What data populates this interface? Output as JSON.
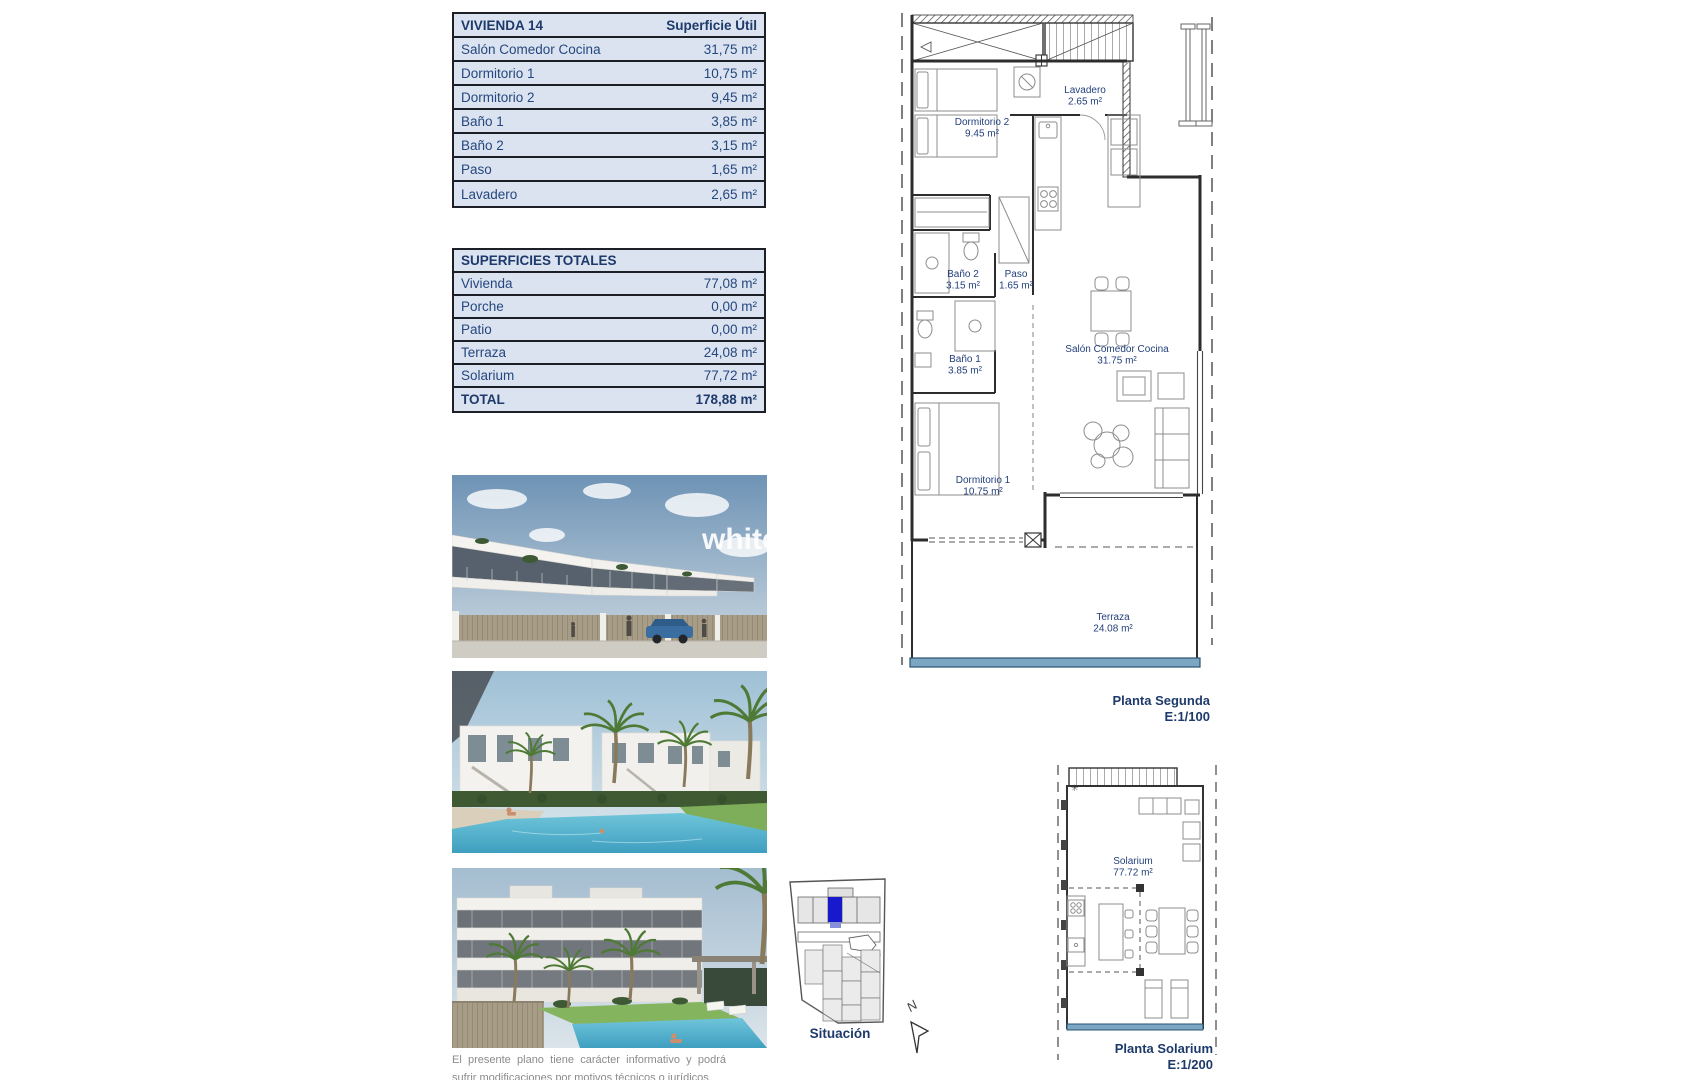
{
  "unit_table": {
    "title": "VIVIENDA 14",
    "column_header": "Superficie Útil",
    "rows": [
      {
        "label": "Salón Comedor Cocina",
        "value": "31,75 m²"
      },
      {
        "label": "Dormitorio 1",
        "value": "10,75 m²"
      },
      {
        "label": "Dormitorio 2",
        "value": "9,45 m²"
      },
      {
        "label": "Baño 1",
        "value": "3,85 m²"
      },
      {
        "label": "Baño 2",
        "value": "3,15 m²"
      },
      {
        "label": "Paso",
        "value": "1,65 m²"
      },
      {
        "label": "Lavadero",
        "value": "2,65 m²"
      }
    ]
  },
  "totals_table": {
    "title": "SUPERFICIES TOTALES",
    "rows": [
      {
        "label": "Vivienda",
        "value": "77,08 m²"
      },
      {
        "label": "Porche",
        "value": "0,00 m²"
      },
      {
        "label": "Patio",
        "value": "0,00 m²"
      },
      {
        "label": "Terraza",
        "value": "24,08 m²"
      },
      {
        "label": "Solarium",
        "value": "77,72 m²"
      }
    ],
    "total_row": {
      "label": "TOTAL",
      "value": "178,88 m²"
    }
  },
  "floor_plan_segunda": {
    "caption": "Planta Segunda",
    "scale": "E:1/100",
    "rooms": [
      {
        "name": "Dormitorio 2",
        "area": "9.45 m²"
      },
      {
        "name": "Lavadero",
        "area": "2.65 m²"
      },
      {
        "name": "Baño 2",
        "area": "3.15 m²"
      },
      {
        "name": "Paso",
        "area": "1.65 m²"
      },
      {
        "name": "Baño 1",
        "area": "3.85 m²"
      },
      {
        "name": "Dormitorio 1",
        "area": "10.75 m²"
      },
      {
        "name": "Salón Comedor Cocina",
        "area": "31.75 m²"
      },
      {
        "name": "Terraza",
        "area": "24.08 m²"
      }
    ]
  },
  "floor_plan_solarium": {
    "caption": "Planta Solarium",
    "scale": "E:1/200",
    "rooms": [
      {
        "name": "Solarium",
        "area": "77.72 m²"
      }
    ]
  },
  "site_plan": {
    "label": "Situación",
    "north_label": "N"
  },
  "photos": {
    "watermark": "white"
  },
  "disclaimer": "El presente plano tiene carácter informativo y podrá sufrir modificaciones por motivos técnicos o jurídicos.",
  "colors": {
    "table_fill": "#dce3f0",
    "table_border": "#1c1f26",
    "text_navy": "#1f3a70",
    "terrace_blue": "#7ca7c4",
    "site_highlight": "#1818cc",
    "pool": "#58b6cf"
  }
}
